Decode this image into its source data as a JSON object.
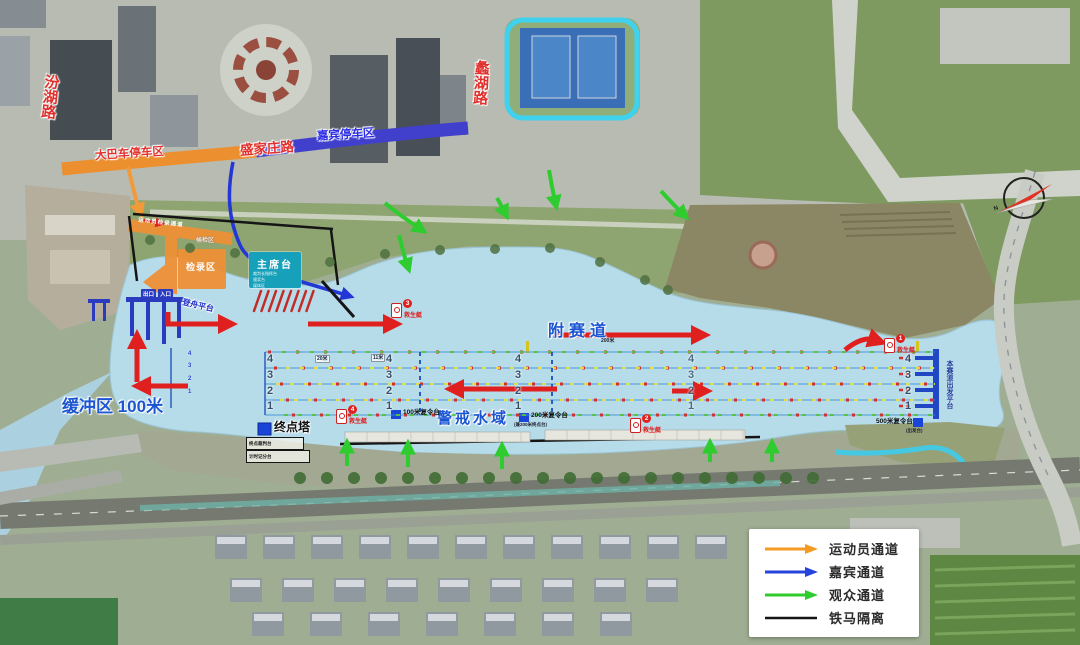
{
  "roads": {
    "fenhu": "汾湖路",
    "cuihu": "蠡湖路",
    "shengjiazhuang": "盛家庄路",
    "bus_parking": "大巴车停车区",
    "vip_parking": "嘉宾停车区"
  },
  "zones": {
    "rostrum": "主席台",
    "rostrum_notes": [
      "裁判长指挥台",
      "颁奖台",
      "媒体区"
    ],
    "check_in": "检录区",
    "waiting": "候检区",
    "athlete_band": "运动员检录通道",
    "boarding_platform": "登舟平台",
    "exit": "出口",
    "entry": "入口"
  },
  "course": {
    "aux_track": "附赛道",
    "aux_track_length": "200米",
    "buffer_zone": "缓冲区 100米",
    "warning_water": "警戒水域",
    "finish_tower": "终点塔",
    "finish_notes": [
      "终点裁判台",
      "计时记分台"
    ],
    "relay_100": "100米复令台",
    "relay_200": "200米复令台",
    "relay_200_note": "(兼200米终点台)",
    "relay_500": "500米复令台",
    "relay_500_note": "(出发台)",
    "start_platform": "本赛道出发平台",
    "lane_numbers": [
      "4",
      "3",
      "2",
      "1"
    ],
    "width_tag_20": "20米",
    "width_tag_11": "11米"
  },
  "markers": {
    "rescue_label": "救生艇",
    "rescue_numbers": [
      "1",
      "2",
      "3",
      "4"
    ]
  },
  "legend": {
    "items": [
      {
        "label": "运动员通道",
        "color": "#f59a23"
      },
      {
        "label": "嘉宾通道",
        "color": "#2643dc"
      },
      {
        "label": "观众通道",
        "color": "#2ecc2e"
      },
      {
        "label": "铁马隔离",
        "color": "#151515"
      }
    ]
  },
  "compass": {
    "north": "N"
  },
  "colors": {
    "water": "#b6dbe9",
    "course_line": "#3a8fd0",
    "athlete_channel": "#f59a23",
    "vip_channel": "#2643dc",
    "spectator_channel": "#2ecc2e",
    "barrier": "#151515",
    "road_text_red": "#e2302c",
    "water_text_blue": "#1b55d2",
    "orange_zone": "#ee9036",
    "rostrum_teal": "#17a0ba"
  }
}
